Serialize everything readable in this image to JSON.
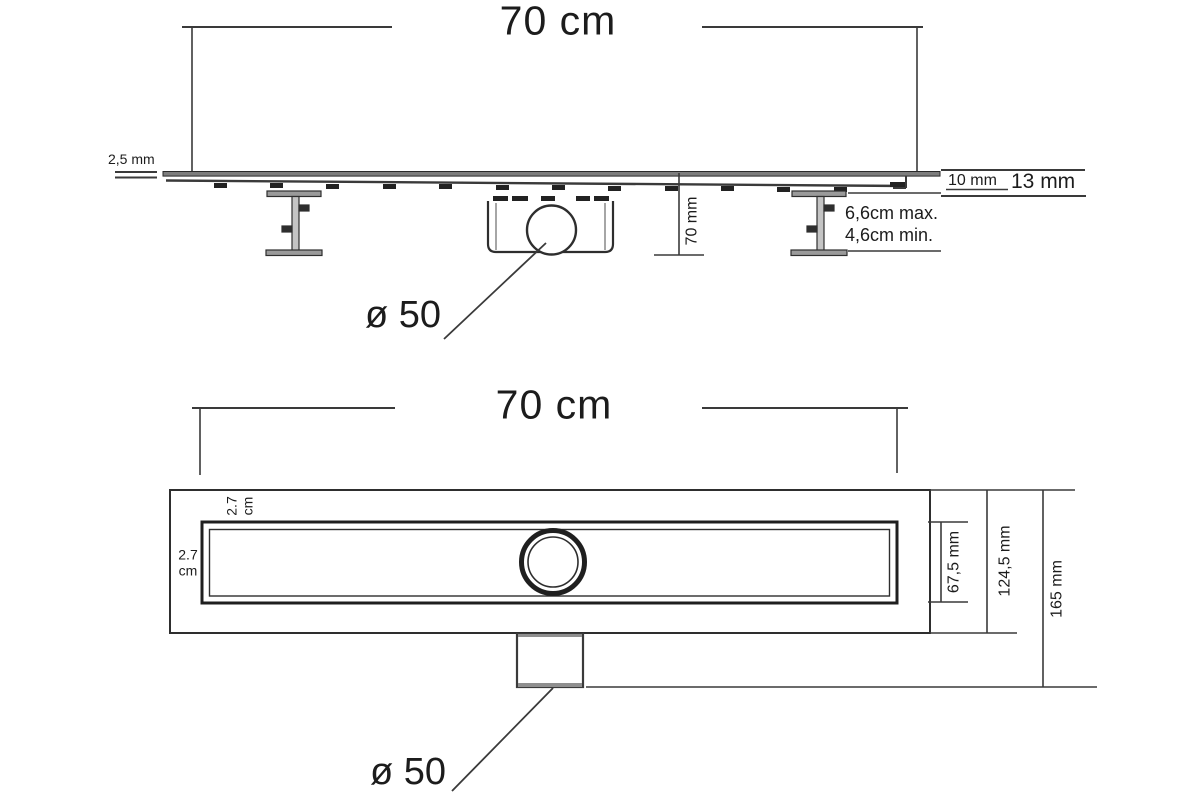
{
  "colors": {
    "background": "#ffffff",
    "line": "#3a3a3a",
    "dark": "#222222",
    "soft_gray": "#8f8f8f",
    "text": "#1c1c1c"
  },
  "side_view": {
    "length_label": "70 cm",
    "tile_gap_label": "2,5 mm",
    "edge_inner_label": "10 mm",
    "edge_outer_label": "13 mm",
    "height_label": "70 mm",
    "foot_max_label": "6,6cm max.",
    "foot_min_label": "4,6cm min.",
    "outlet_label": "ø 50"
  },
  "plan_view": {
    "length_label": "70 cm",
    "top_margin_value": "2.7",
    "top_margin_unit": "cm",
    "left_margin_value": "2.7",
    "left_margin_unit": "cm",
    "grate_width_label": "67,5 mm",
    "body_width_label": "124,5 mm",
    "total_width_label": "165 mm",
    "outlet_label": "ø 50"
  }
}
